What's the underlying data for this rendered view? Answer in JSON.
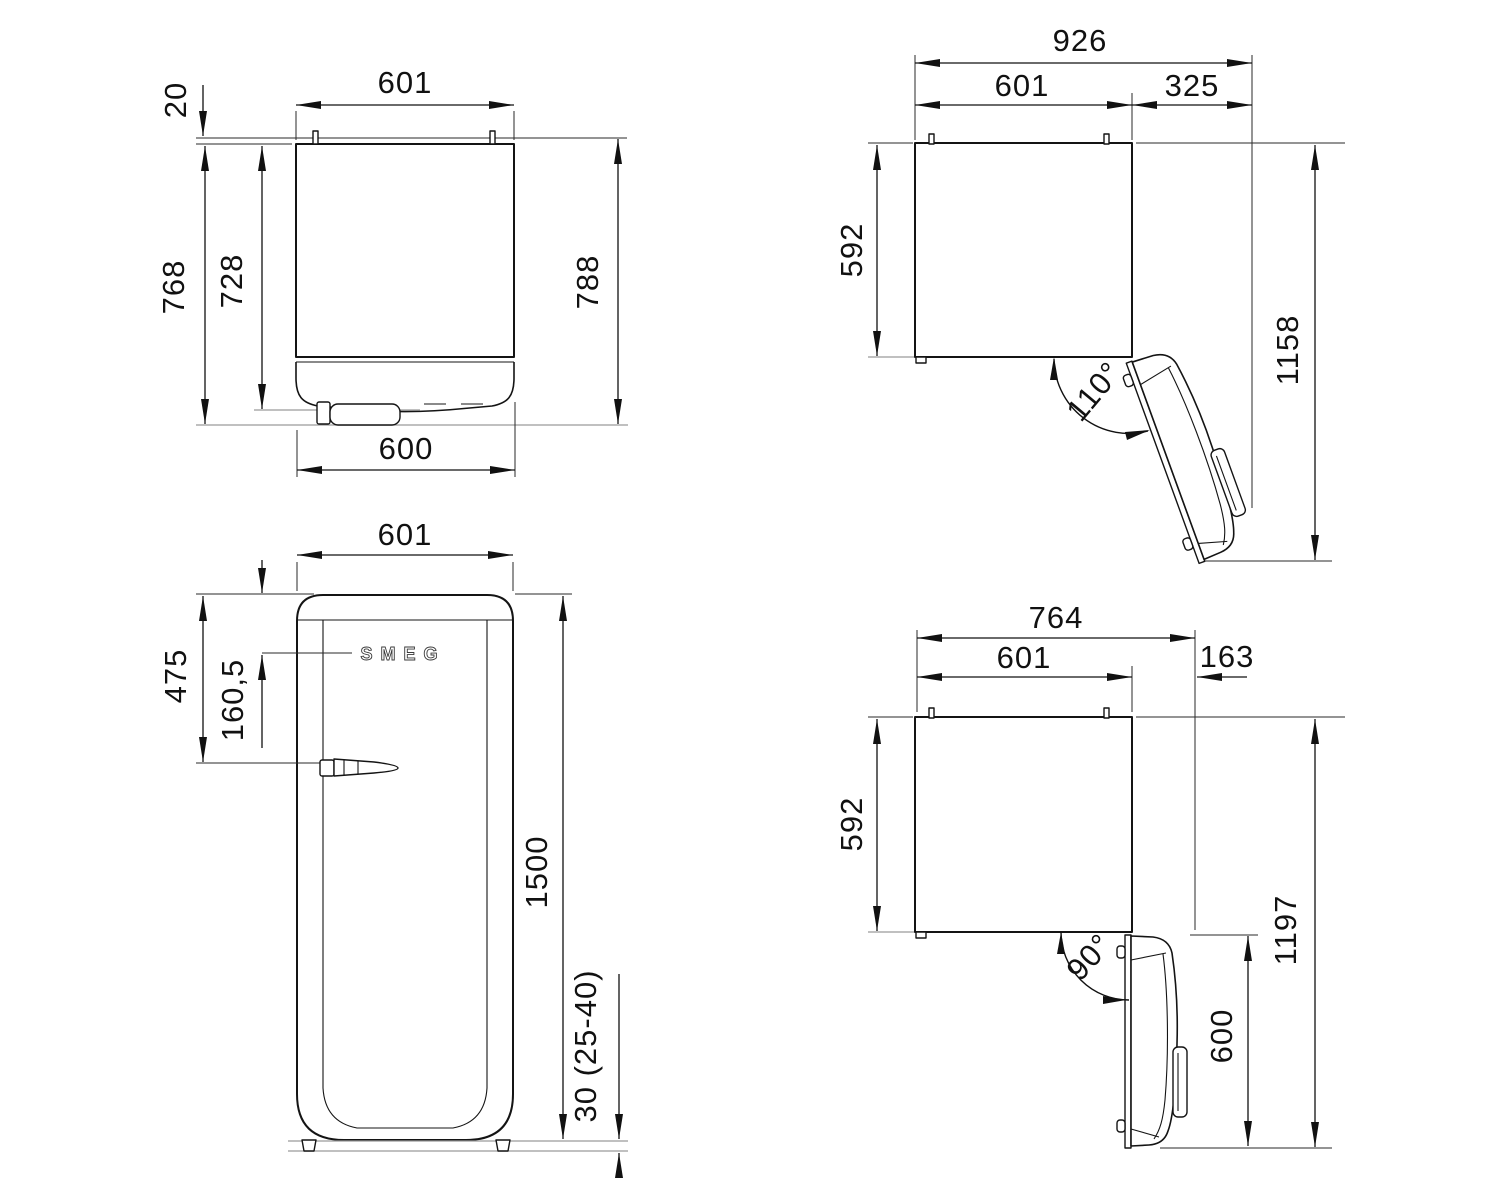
{
  "top_view": {
    "width": "601",
    "hinge_rear_offset": "20",
    "depth_to_handle": "768",
    "depth_body": "728",
    "depth_overall": "788",
    "door_width": "600"
  },
  "door_open_110_view": {
    "overall_width": "926",
    "body_width": "601",
    "door_projection": "325",
    "body_depth": "592",
    "overall_depth": "1158",
    "open_angle": "110°"
  },
  "front_view": {
    "brand_logo": "SMEG",
    "width": "601",
    "handle_from_top": "475",
    "logo_from_top": "160,5",
    "height": "1500",
    "feet_height": "30 (25-40)"
  },
  "door_open_90_view": {
    "overall_width": "764",
    "body_width": "601",
    "door_projection": "163",
    "body_depth": "592",
    "overall_depth": "1197",
    "door_depth": "600",
    "open_angle": "90°"
  }
}
